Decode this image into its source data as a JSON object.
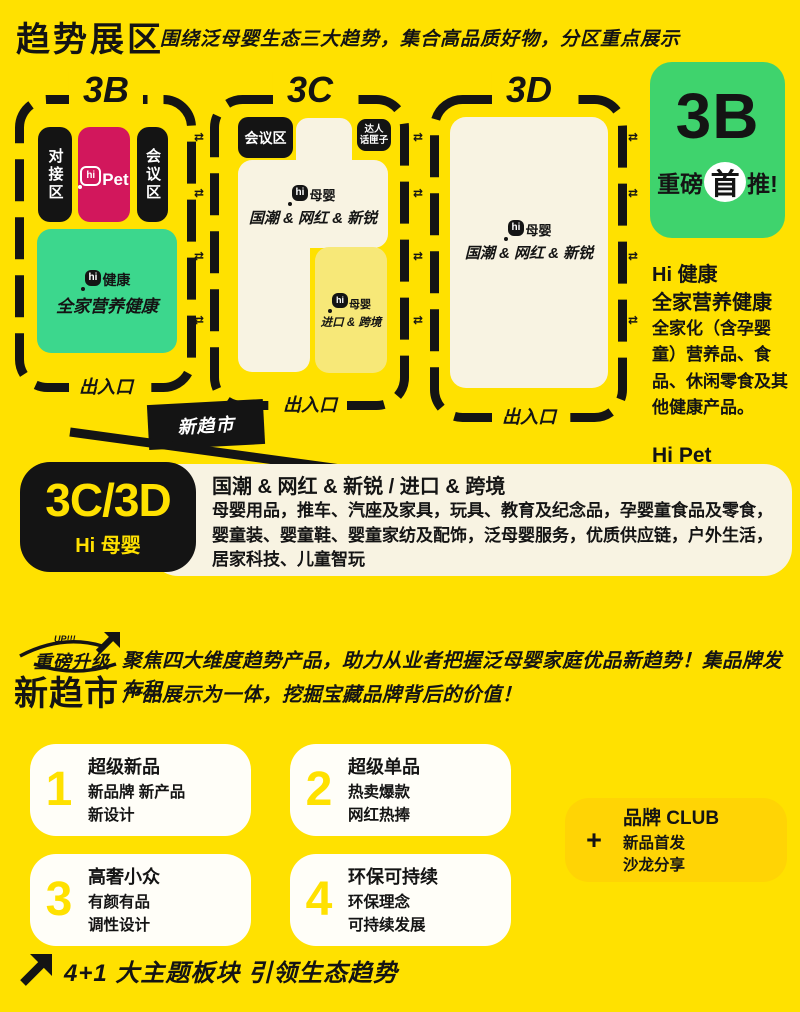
{
  "header": {
    "title": "趋势展区",
    "subtitle": "围绕泛母婴生态三大趋势，集合高品质好物，分区重点展示"
  },
  "map": {
    "transfer_symbol": "⇄",
    "flag": "新趋市",
    "zone_3b": {
      "label": "3B",
      "exit": "出入口",
      "dock_area": "对接区",
      "meeting_area": "会议区",
      "pet": {
        "hi": "hi",
        "name": "Pet"
      },
      "health": {
        "hi": "hi",
        "name": "健康",
        "title": "全家营养健康"
      }
    },
    "zone_3c": {
      "label": "3C",
      "exit": "出入口",
      "meeting_area": "会议区",
      "talk_line1": "达人",
      "talk_line2": "话匣子",
      "main": {
        "hi": "hi",
        "name": "母婴",
        "title": "国潮 & 网红 & 新锐"
      },
      "import": {
        "hi": "hi",
        "name": "母婴",
        "title": "进口 & 跨境"
      }
    },
    "zone_3d": {
      "label": "3D",
      "exit": "出入口",
      "main": {
        "hi": "hi",
        "name": "母婴",
        "title": "国潮 & 网红 & 新锐"
      }
    }
  },
  "sidebar": {
    "badge_zone": "3B",
    "badge_pre": "重磅",
    "badge_highlight": "首",
    "badge_post": "推!",
    "health_title": "Hi 健康",
    "health_subtitle": "全家营养健康",
    "health_body": "全家化（含孕婴童）营养品、食品、休闲零食及其他健康产品。",
    "pet_title": "Hi Pet",
    "pet_body": "宠物用品，宠物食品及营养品，户外 & 出行产品"
  },
  "legend": {
    "zone": "3C/3D",
    "zone_sub": "Hi 母婴",
    "title": "国潮 & 网红 & 新锐 / 进口 & 跨境",
    "body": "母婴用品，推车、汽座及家具，玩具、教育及纪念品，孕婴童食品及零食，婴童装、婴童鞋、婴童家纺及配饰，泛母婴服务，优质供应链，户外生活，居家科技、儿童智玩"
  },
  "upgrade": {
    "up_text": "UP!!!",
    "line1": "重磅升级",
    "line2": "新趋市",
    "desc_line1": "聚焦四大维度趋势产品，助力从业者把握泛母婴家庭优品新趋势！集品牌发布和",
    "desc_line2": "产品展示为一体，挖掘宝藏品牌背后的价值！"
  },
  "cards": [
    {
      "num": "1",
      "title": "超级新品",
      "line1": "新品牌 新产品",
      "line2": "新设计"
    },
    {
      "num": "2",
      "title": "超级单品",
      "line1": "热卖爆款",
      "line2": "网红热捧"
    },
    {
      "num": "3",
      "title": "高奢小众",
      "line1": "有颜有品",
      "line2": "调性设计"
    },
    {
      "num": "4",
      "title": "环保可持续",
      "line1": "环保理念",
      "line2": "可持续发展"
    }
  ],
  "club": {
    "plus": "+",
    "title": "品牌 CLUB",
    "line1": "新品首发",
    "line2": "沙龙分享"
  },
  "footer": {
    "text": "4+1 大主题板块 引领生态趋势"
  },
  "colors": {
    "background": "#FFE100",
    "ink": "#141414",
    "pink": "#D2175C",
    "map_green": "#3CD78D",
    "badge_green": "#3FD36D",
    "cream": "#F8F3E2",
    "pale_yellow": "#F7E878",
    "card_white": "#FFFEF8",
    "club_gold": "#FFD405",
    "number_yellow": "#FFE100"
  }
}
